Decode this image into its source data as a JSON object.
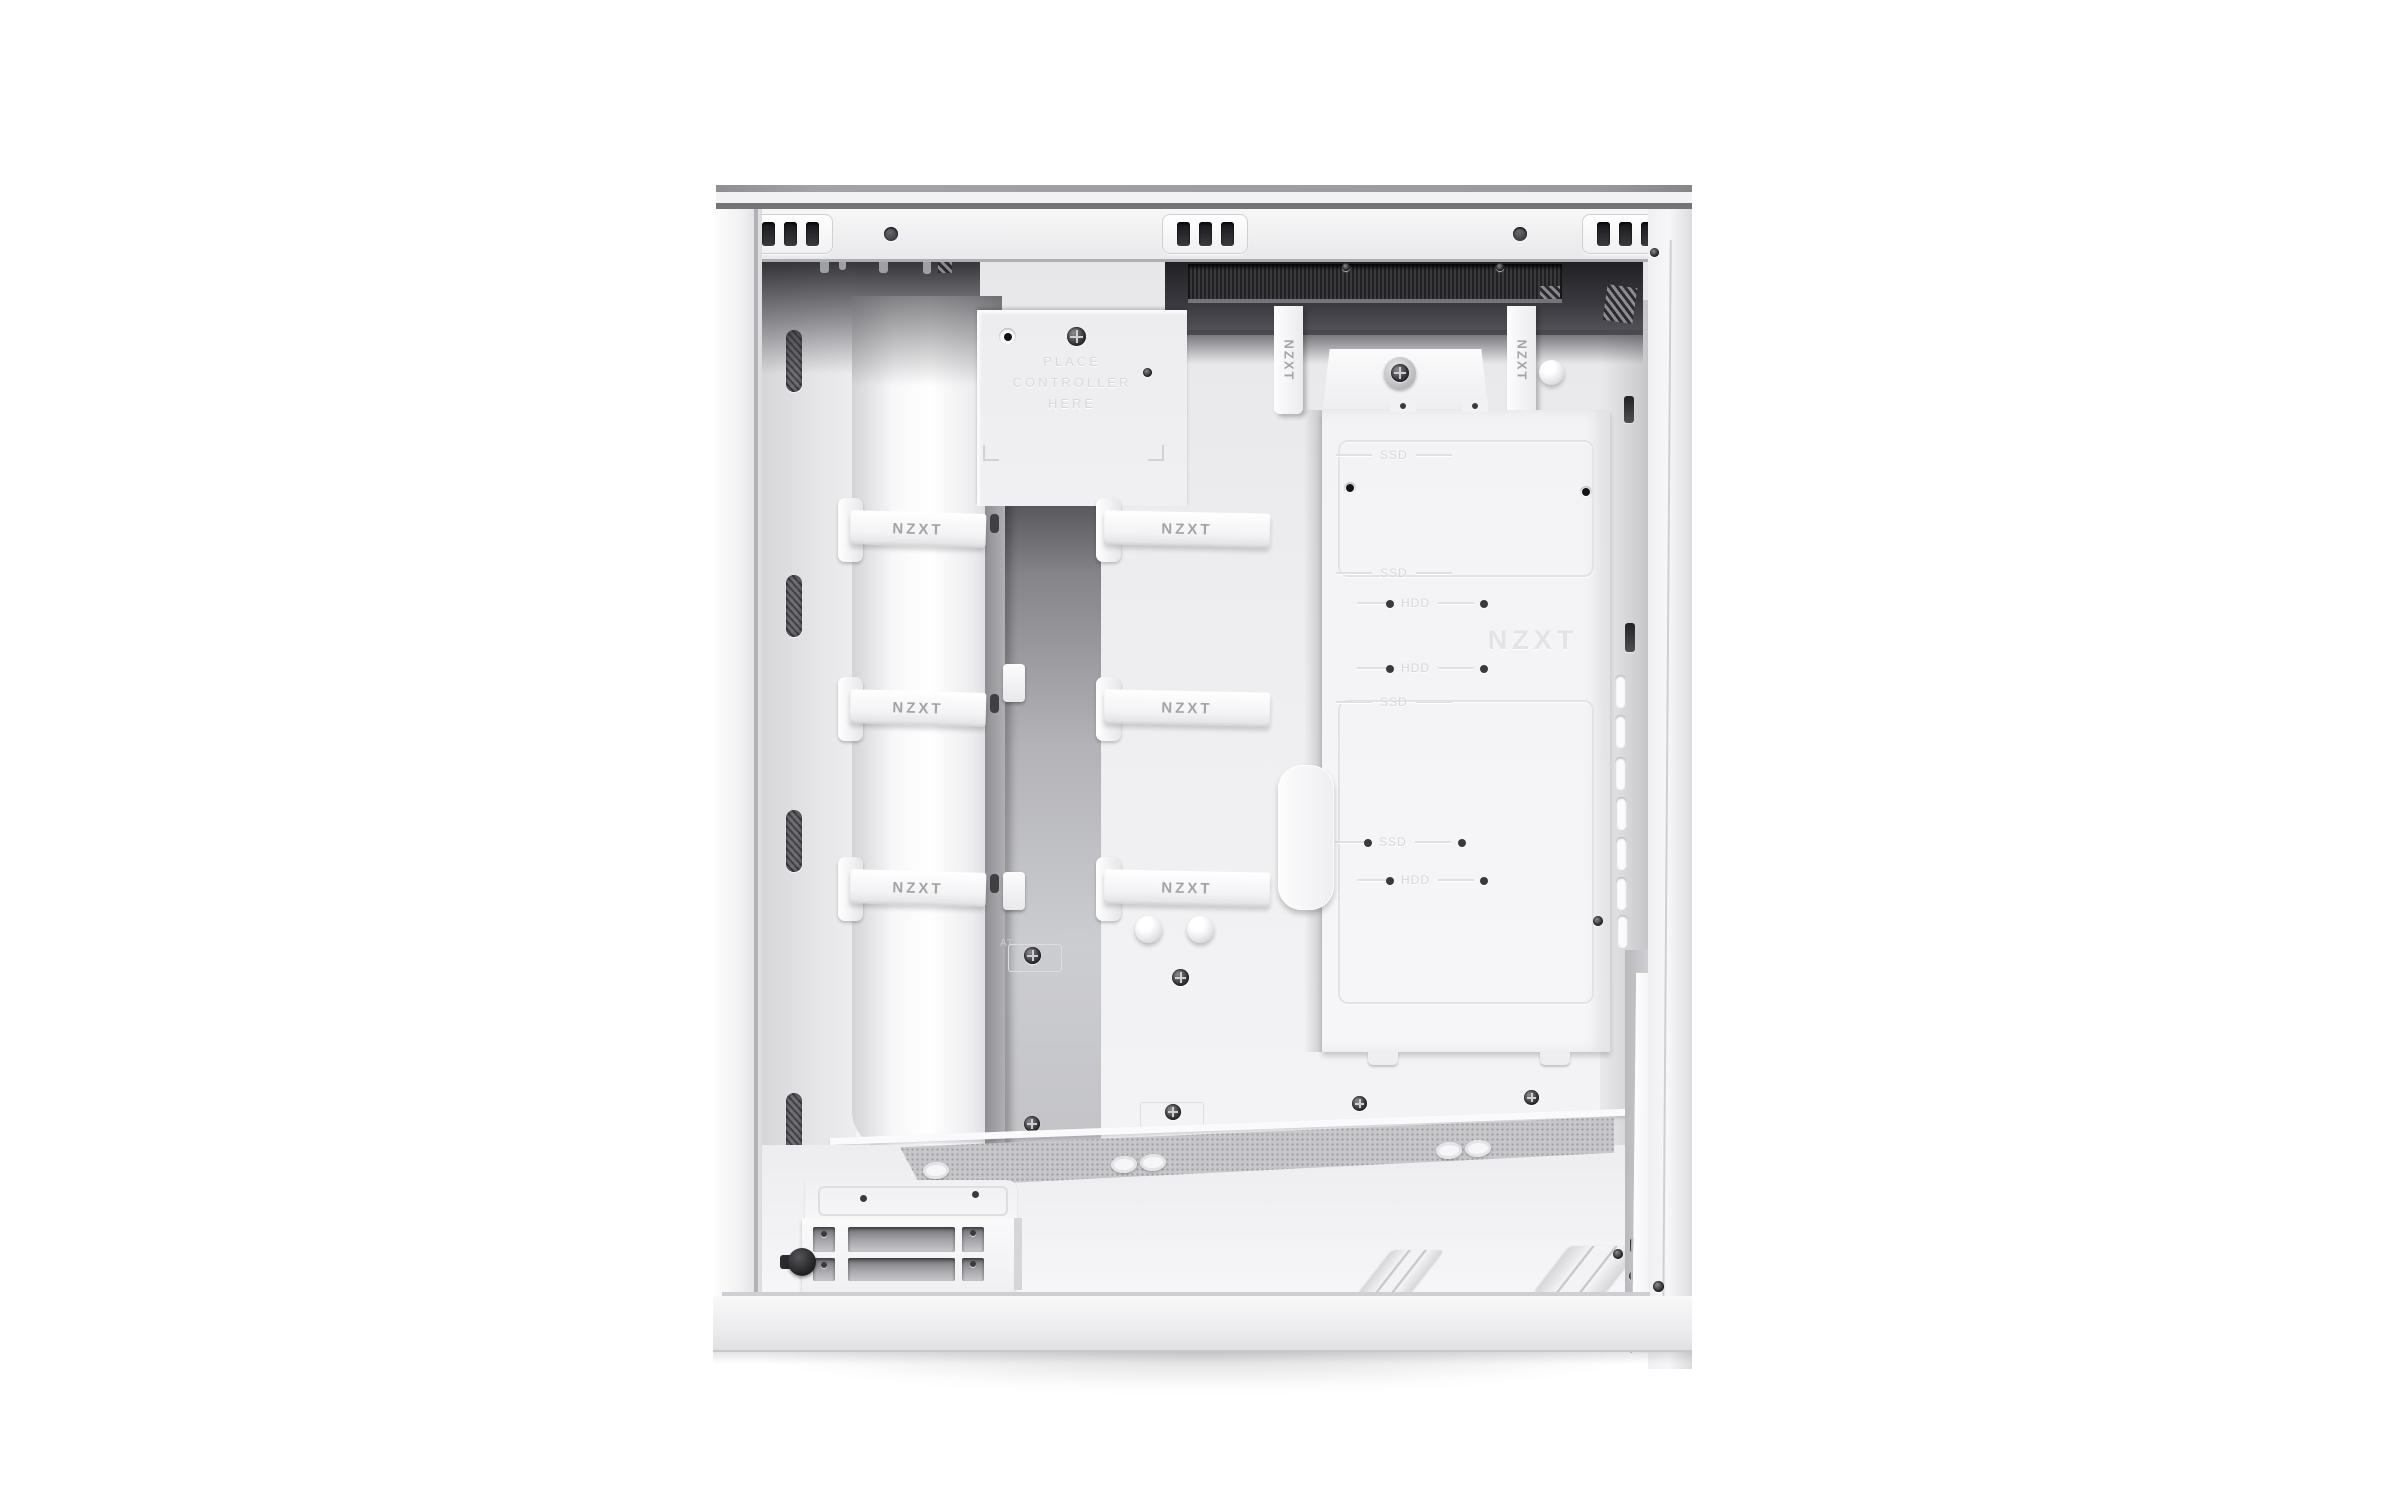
{
  "scene": {
    "type": "product-photo",
    "subject": "Mid-tower PC case interior, side panel removed, cable-management side",
    "brand": "NZXT",
    "finish": "matte white"
  },
  "palette": {
    "background": "#ffffff",
    "case_white": "#f3f3f5",
    "panel_gray": "#e9e9eb",
    "recess_dark": "#2a2a2d",
    "mesh_dark": "#28282b",
    "emboss_text": "#d9d9dc",
    "strap_text": "#a3a4a8"
  },
  "labels": {
    "controller": {
      "line1": "PLACE",
      "line2": "CONTROLLER",
      "line3": "HERE"
    },
    "strap": "NZXT",
    "watermark": "NZXT",
    "standoff_left": "ATX",
    "standoff_right": "EATX"
  },
  "top_rail": {
    "clip_groups": 3,
    "slots_per_group": 3,
    "round_holes": 2,
    "corner_screws_per_side": 2
  },
  "straps": {
    "horizontal_rows": 3,
    "horizontal_columns": 2,
    "vertical_count": 2
  },
  "drive_tray": {
    "labels": [
      {
        "text": "SSD"
      },
      {
        "text": "SSD"
      },
      {
        "text": "HDD"
      },
      {
        "text": "HDD"
      },
      {
        "text": "SSD"
      },
      {
        "text": "SSD"
      },
      {
        "text": "HDD"
      }
    ],
    "watermark": "NZXT",
    "tray_outlines": 2
  },
  "rear_panel": {
    "vent_slots": 7,
    "hook_cutouts": 2
  },
  "left_wall": {
    "vent_slots": 4
  },
  "drive_cage": {
    "cutout_rows": 2,
    "thumbscrews": 1
  },
  "psu_floor": {
    "rails": 2,
    "grommets": 5
  }
}
